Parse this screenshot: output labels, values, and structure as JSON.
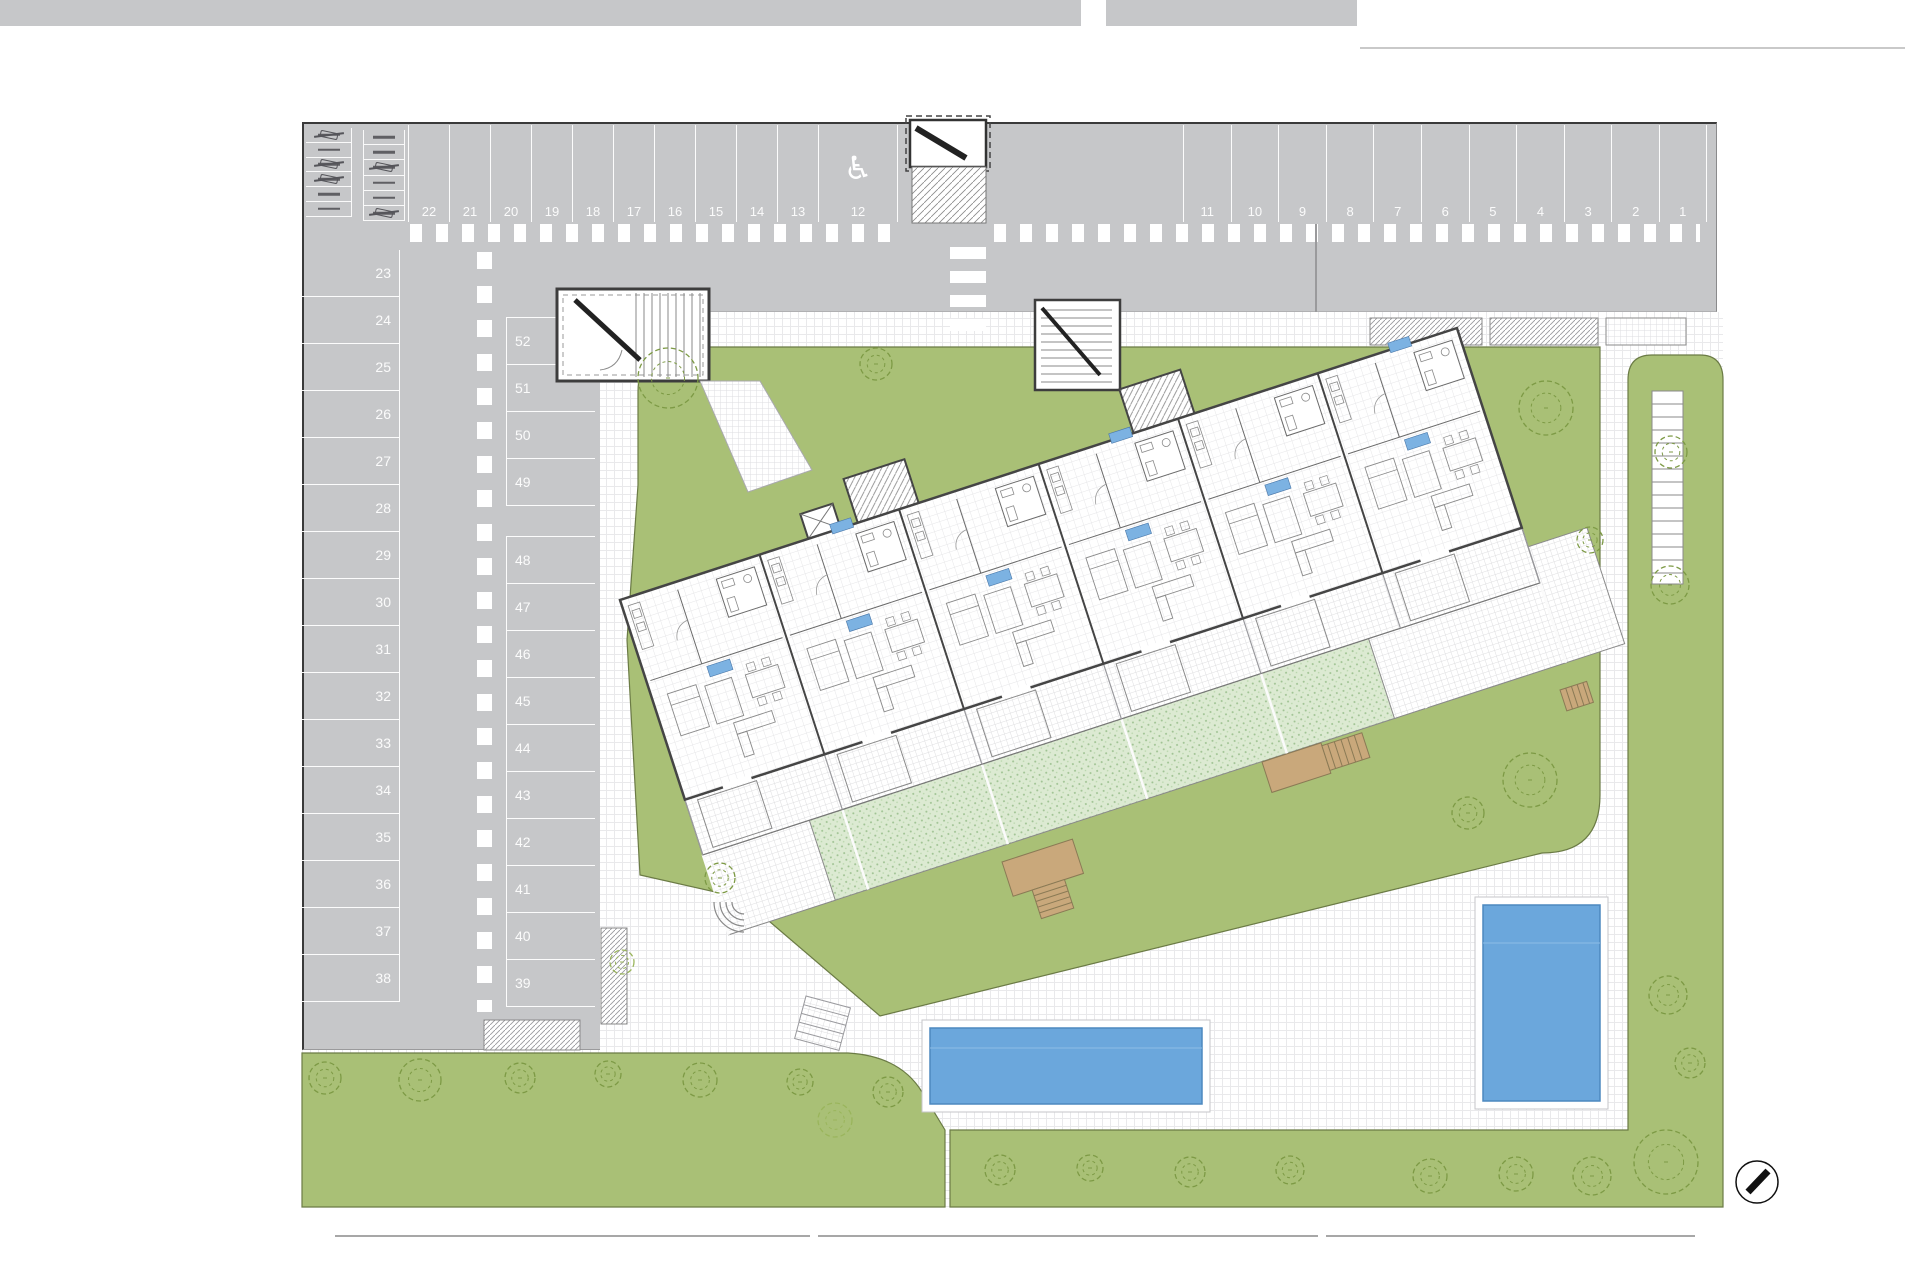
{
  "plan": {
    "type": "residential site plan",
    "parking": {
      "top_left": [
        "22",
        "21",
        "20",
        "19",
        "18",
        "17",
        "16",
        "15",
        "14",
        "13"
      ],
      "handicap_space": "12",
      "top_right": [
        "11",
        "10",
        "9",
        "8",
        "7",
        "6",
        "5",
        "4",
        "3",
        "2",
        "1"
      ],
      "left_column": [
        "23",
        "24",
        "25",
        "26",
        "27",
        "28",
        "29",
        "30",
        "31",
        "32",
        "33",
        "34",
        "35",
        "36",
        "37",
        "38"
      ],
      "middle_column_upper": [
        "52",
        "51",
        "50",
        "49"
      ],
      "middle_column_lower": [
        "48",
        "47",
        "46",
        "45",
        "44",
        "43",
        "42",
        "41",
        "40",
        "39"
      ]
    },
    "labels": {
      "ramp": "PTE 6%"
    },
    "icons": {
      "handicap": "♿",
      "compass": "north-needle"
    },
    "colors": {
      "asphalt": "#c6c7c9",
      "marking": "#ffffff",
      "grass": "#a9c076",
      "garden_stipple": "#dcead2",
      "pool": "#6ba7dc",
      "stair": "#c9a87b",
      "unit_tag": "#7cb2e2",
      "wall": "#454545"
    }
  }
}
